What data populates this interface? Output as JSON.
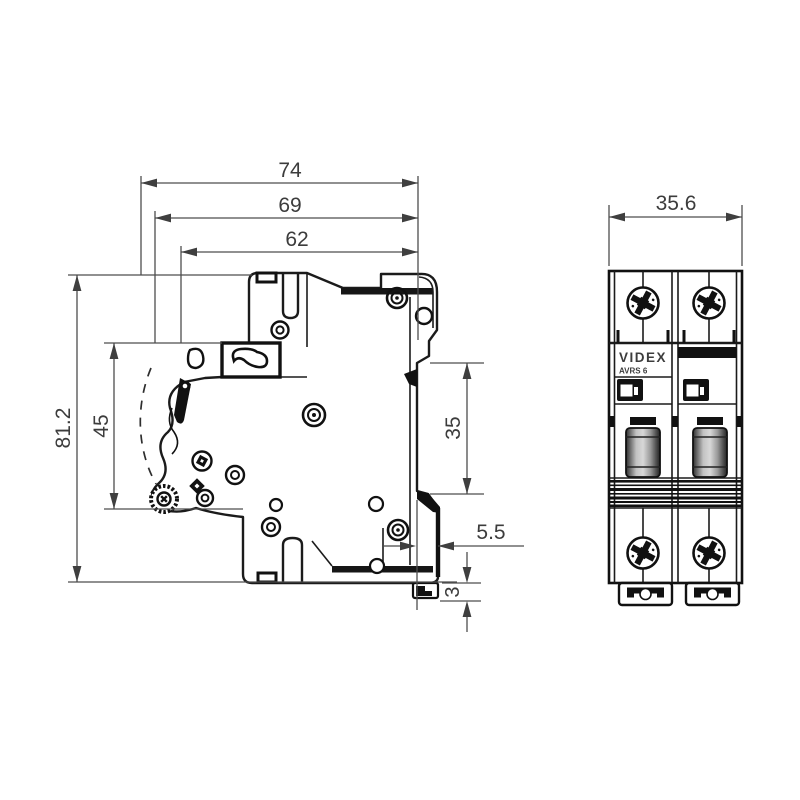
{
  "side_view": {
    "dimensions": {
      "overall_depth": "74",
      "depth_without_terminal": "69",
      "body_depth": "62",
      "overall_height": "81.2",
      "front_section_height": "45",
      "din_rail_slot_height": "35",
      "din_rail_recess_depth": "5.5",
      "clip_foot_height": "3"
    }
  },
  "front_view": {
    "dimensions": {
      "overall_width": "35.6"
    },
    "label": {
      "brand": "VIDEX",
      "model": "AVRS 6"
    },
    "icons": {
      "terminal_screw": "phillips-screw-icon",
      "toggle": "switch-lever",
      "mount": "din-rail-clip"
    }
  },
  "colors": {
    "background": "#ffffff",
    "outline": "#1b1b1b",
    "dimension": "#4a4a4a"
  }
}
